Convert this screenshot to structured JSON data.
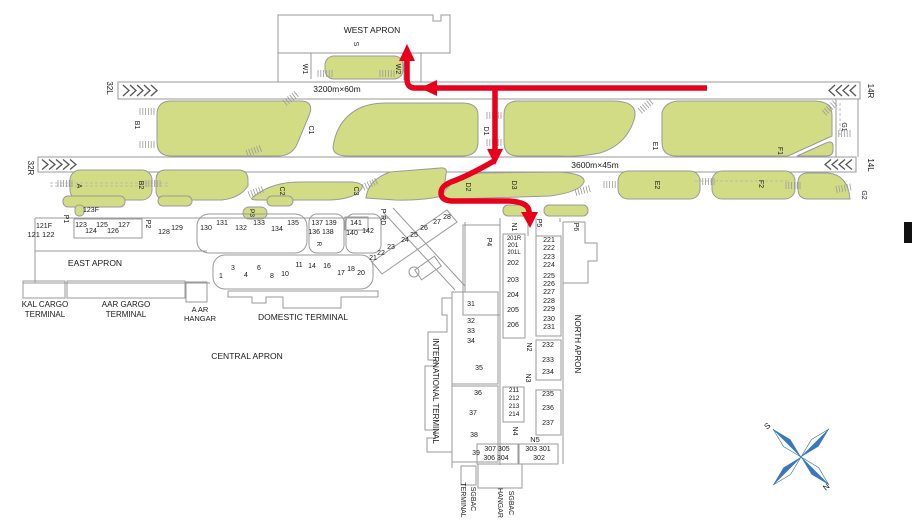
{
  "colors": {
    "island_green": "#d2dc85",
    "outline_gray": "#9a9a9a",
    "route_red": "#e8001c",
    "compass_blue": "#3a77bb",
    "text": "#1a1a1a"
  },
  "route": {
    "color": "#e8001c",
    "style": "arrow-path"
  },
  "labels": [
    {
      "n": "apron-west-label",
      "t": "WEST APRON",
      "x": 372,
      "y": 33,
      "r": 0,
      "fs": 8.5
    },
    {
      "n": "taxiway-label-s",
      "t": "S",
      "x": 354,
      "y": 44,
      "r": 90,
      "fs": 7
    },
    {
      "n": "taxiway-label-w1",
      "t": "W1",
      "x": 303,
      "y": 69,
      "r": 90,
      "fs": 7
    },
    {
      "n": "taxiway-label-w2",
      "t": "W2",
      "x": 396,
      "y": 69,
      "r": 90,
      "fs": 7
    },
    {
      "n": "runway-dimensions-1",
      "t": "3200m×60m",
      "x": 337,
      "y": 92,
      "r": 0,
      "fs": 8.5
    },
    {
      "n": "runway-dimensions-2",
      "t": "3600m×45m",
      "x": 595,
      "y": 168,
      "r": 0,
      "fs": 8.5
    },
    {
      "n": "runway-designator-32l",
      "t": "32L",
      "x": 107,
      "y": 88,
      "r": 90,
      "fs": 8
    },
    {
      "n": "runway-designator-32r",
      "t": "32R",
      "x": 28,
      "y": 168,
      "r": 90,
      "fs": 8
    },
    {
      "n": "runway-designator-14r",
      "t": "14R",
      "x": 868,
      "y": 91,
      "r": 90,
      "fs": 8
    },
    {
      "n": "runway-designator-14l",
      "t": "14L",
      "x": 868,
      "y": 165,
      "r": 90,
      "fs": 8
    },
    {
      "n": "taxiway-label-a",
      "t": "A",
      "x": 77,
      "y": 186,
      "r": 90,
      "fs": 7
    },
    {
      "n": "taxiway-label-b1",
      "t": "B1",
      "x": 135,
      "y": 125,
      "r": 90,
      "fs": 7
    },
    {
      "n": "taxiway-label-b2",
      "t": "B2",
      "x": 139,
      "y": 185,
      "r": 90,
      "fs": 7
    },
    {
      "n": "taxiway-label-c1",
      "t": "C1",
      "x": 309,
      "y": 130,
      "r": 90,
      "fs": 7
    },
    {
      "n": "taxiway-label-c2",
      "t": "C2",
      "x": 280,
      "y": 191,
      "r": 90,
      "fs": 7
    },
    {
      "n": "taxiway-label-c3",
      "t": "C3",
      "x": 354,
      "y": 191,
      "r": 90,
      "fs": 7
    },
    {
      "n": "taxiway-label-d1",
      "t": "D1",
      "x": 484,
      "y": 131,
      "r": 90,
      "fs": 7
    },
    {
      "n": "taxiway-label-d2",
      "t": "D2",
      "x": 466,
      "y": 187,
      "r": 90,
      "fs": 7
    },
    {
      "n": "taxiway-label-d3",
      "t": "D3",
      "x": 512,
      "y": 185,
      "r": 90,
      "fs": 7
    },
    {
      "n": "taxiway-label-e1",
      "t": "E1",
      "x": 653,
      "y": 146,
      "r": 90,
      "fs": 7
    },
    {
      "n": "taxiway-label-e2",
      "t": "E2",
      "x": 655,
      "y": 185,
      "r": 90,
      "fs": 7
    },
    {
      "n": "taxiway-label-f1",
      "t": "F1",
      "x": 778,
      "y": 151,
      "r": 90,
      "fs": 7
    },
    {
      "n": "taxiway-label-f2",
      "t": "F2",
      "x": 759,
      "y": 184,
      "r": 90,
      "fs": 7
    },
    {
      "n": "taxiway-label-g1",
      "t": "G1",
      "x": 842,
      "y": 127,
      "r": 90,
      "fs": 7
    },
    {
      "n": "taxiway-label-g2",
      "t": "G2",
      "x": 862,
      "y": 195,
      "r": 90,
      "fs": 7
    },
    {
      "n": "stand-121f",
      "t": "121F",
      "x": 44,
      "y": 228,
      "r": 0,
      "fs": 7
    },
    {
      "n": "stand-121-122",
      "t": "121 122",
      "x": 41,
      "y": 237,
      "r": 0,
      "fs": 7.5
    },
    {
      "n": "taxiway-label-p1",
      "t": "P1",
      "x": 64,
      "y": 219,
      "r": 90,
      "fs": 7
    },
    {
      "n": "stand-123f",
      "t": "123F",
      "x": 91,
      "y": 212,
      "r": 0,
      "fs": 7
    },
    {
      "n": "stand-123",
      "t": "123",
      "x": 81,
      "y": 227,
      "r": 0,
      "fs": 7
    },
    {
      "n": "stand-124",
      "t": "124",
      "x": 91,
      "y": 233,
      "r": 0,
      "fs": 7
    },
    {
      "n": "stand-125",
      "t": "125",
      "x": 102,
      "y": 227,
      "r": 0,
      "fs": 7
    },
    {
      "n": "stand-126",
      "t": "126",
      "x": 113,
      "y": 233,
      "r": 0,
      "fs": 7
    },
    {
      "n": "stand-127",
      "t": "127",
      "x": 124,
      "y": 227,
      "r": 0,
      "fs": 7
    },
    {
      "n": "taxiway-label-p2",
      "t": "P2",
      "x": 146,
      "y": 224,
      "r": 90,
      "fs": 7
    },
    {
      "n": "stand-128",
      "t": "128",
      "x": 164,
      "y": 234,
      "r": 0,
      "fs": 7
    },
    {
      "n": "stand-129",
      "t": "129",
      "x": 177,
      "y": 230,
      "r": 0,
      "fs": 7
    },
    {
      "n": "stand-130",
      "t": "130",
      "x": 206,
      "y": 230,
      "r": 0,
      "fs": 7
    },
    {
      "n": "stand-131",
      "t": "131",
      "x": 222,
      "y": 225,
      "r": 0,
      "fs": 7
    },
    {
      "n": "stand-132",
      "t": "132",
      "x": 241,
      "y": 230,
      "r": 0,
      "fs": 7
    },
    {
      "n": "stand-133",
      "t": "133",
      "x": 259,
      "y": 225,
      "r": 0,
      "fs": 7
    },
    {
      "n": "stand-134",
      "t": "134",
      "x": 277,
      "y": 231,
      "r": 0,
      "fs": 7
    },
    {
      "n": "stand-135",
      "t": "135",
      "x": 293,
      "y": 225,
      "r": 0,
      "fs": 7
    },
    {
      "n": "stand-137-139",
      "t": "137 139",
      "x": 324,
      "y": 225,
      "r": 0,
      "fs": 7
    },
    {
      "n": "stand-136-138",
      "t": "136 138",
      "x": 321,
      "y": 234,
      "r": 0,
      "fs": 7
    },
    {
      "n": "taxiway-label-r",
      "t": "R",
      "x": 317,
      "y": 244,
      "r": 90,
      "fs": 6.5
    },
    {
      "n": "stand-141",
      "t": "141",
      "x": 356,
      "y": 225,
      "r": 0,
      "fs": 7
    },
    {
      "n": "stand-140",
      "t": "140",
      "x": 352,
      "y": 235,
      "r": 0,
      "fs": 7
    },
    {
      "n": "stand-142",
      "t": "142",
      "x": 368,
      "y": 233,
      "r": 0,
      "fs": 7
    },
    {
      "n": "taxiway-label-p3",
      "t": "P3",
      "x": 250,
      "y": 213,
      "r": 90,
      "fs": 6.5
    },
    {
      "n": "road-label-p-rd",
      "t": "P RD",
      "x": 381,
      "y": 217,
      "r": 90,
      "fs": 7
    },
    {
      "n": "apron-east-label",
      "t": "EAST APRON",
      "x": 95,
      "y": 266,
      "r": 0,
      "fs": 8.5
    },
    {
      "n": "stand-1",
      "t": "1",
      "x": 221,
      "y": 278,
      "r": 0,
      "fs": 7
    },
    {
      "n": "stand-3",
      "t": "3",
      "x": 233,
      "y": 270,
      "r": 0,
      "fs": 7
    },
    {
      "n": "stand-4",
      "t": "4",
      "x": 246,
      "y": 277,
      "r": 0,
      "fs": 7
    },
    {
      "n": "stand-6",
      "t": "6",
      "x": 259,
      "y": 270,
      "r": 0,
      "fs": 7
    },
    {
      "n": "stand-8",
      "t": "8",
      "x": 272,
      "y": 278,
      "r": 0,
      "fs": 7
    },
    {
      "n": "stand-10",
      "t": "10",
      "x": 285,
      "y": 276,
      "r": 0,
      "fs": 7
    },
    {
      "n": "stand-11",
      "t": "11",
      "x": 299,
      "y": 267,
      "r": 0,
      "fs": 7
    },
    {
      "n": "stand-14",
      "t": "14",
      "x": 312,
      "y": 268,
      "r": 0,
      "fs": 7
    },
    {
      "n": "stand-16",
      "t": "16",
      "x": 327,
      "y": 268,
      "r": 0,
      "fs": 7
    },
    {
      "n": "stand-17",
      "t": "17",
      "x": 341,
      "y": 275,
      "r": 0,
      "fs": 7
    },
    {
      "n": "stand-18",
      "t": "18",
      "x": 351,
      "y": 271,
      "r": 0,
      "fs": 7
    },
    {
      "n": "stand-20",
      "t": "20",
      "x": 361,
      "y": 275,
      "r": 0,
      "fs": 7
    },
    {
      "n": "stand-21",
      "t": "21",
      "x": 373,
      "y": 260,
      "r": 0,
      "fs": 7
    },
    {
      "n": "stand-22",
      "t": "22",
      "x": 381,
      "y": 255,
      "r": 0,
      "fs": 7
    },
    {
      "n": "stand-23",
      "t": "23",
      "x": 391,
      "y": 249,
      "r": 0,
      "fs": 7
    },
    {
      "n": "stand-24",
      "t": "24",
      "x": 405,
      "y": 242,
      "r": 0,
      "fs": 7
    },
    {
      "n": "stand-25",
      "t": "25",
      "x": 414,
      "y": 237,
      "r": 0,
      "fs": 7
    },
    {
      "n": "stand-26",
      "t": "26",
      "x": 424,
      "y": 230,
      "r": 0,
      "fs": 7
    },
    {
      "n": "stand-27",
      "t": "27",
      "x": 437,
      "y": 224,
      "r": 0,
      "fs": 7
    },
    {
      "n": "stand-28",
      "t": "28",
      "x": 447,
      "y": 219,
      "r": 0,
      "fs": 7
    },
    {
      "n": "terminal-kal-cargo-line1",
      "t": "KAL CARGO",
      "x": 45,
      "y": 307,
      "r": 0,
      "fs": 8
    },
    {
      "n": "terminal-kal-cargo-line2",
      "t": "TERMINAL",
      "x": 45,
      "y": 317,
      "r": 0,
      "fs": 8
    },
    {
      "n": "terminal-aar-cargo-line1",
      "t": "AAR GARGO",
      "x": 126,
      "y": 307,
      "r": 0,
      "fs": 8
    },
    {
      "n": "terminal-aar-cargo-line2",
      "t": "TERMINAL",
      "x": 126,
      "y": 317,
      "r": 0,
      "fs": 8
    },
    {
      "n": "terminal-aar-hangar-line1",
      "t": "A AR",
      "x": 200,
      "y": 312,
      "r": 0,
      "fs": 7.5
    },
    {
      "n": "terminal-aar-hangar-line2",
      "t": "HANGAR",
      "x": 200,
      "y": 321,
      "r": 0,
      "fs": 7.5
    },
    {
      "n": "terminal-domestic-label",
      "t": "DOMESTIC TERMINAL",
      "x": 303,
      "y": 320,
      "r": 0,
      "fs": 8.5
    },
    {
      "n": "apron-central-label",
      "t": "CENTRAL APRON",
      "x": 247,
      "y": 359,
      "r": 0,
      "fs": 8.5
    },
    {
      "n": "terminal-international-label",
      "t": "INTERNATIONAL TERMINAL",
      "x": 433,
      "y": 391,
      "r": 90,
      "fs": 8
    },
    {
      "n": "apron-north-label",
      "t": "NORTH APRON",
      "x": 575,
      "y": 344,
      "r": 90,
      "fs": 8
    },
    {
      "n": "taxiway-label-p4",
      "t": "P4",
      "x": 487,
      "y": 242,
      "r": 90,
      "fs": 7
    },
    {
      "n": "taxiway-label-n1",
      "t": "N1",
      "x": 512,
      "y": 227,
      "r": 90,
      "fs": 7
    },
    {
      "n": "taxiway-label-p5",
      "t": "P5",
      "x": 537,
      "y": 223,
      "r": 90,
      "fs": 7
    },
    {
      "n": "taxiway-label-p6",
      "t": "P6",
      "x": 574,
      "y": 227,
      "r": 90,
      "fs": 7
    },
    {
      "n": "stand-201r",
      "t": "201R",
      "x": 514,
      "y": 240,
      "r": 0,
      "fs": 6
    },
    {
      "n": "stand-201",
      "t": "201",
      "x": 513,
      "y": 247,
      "r": 0,
      "fs": 6.5
    },
    {
      "n": "stand-201l",
      "t": "201L",
      "x": 514,
      "y": 254,
      "r": 0,
      "fs": 6
    },
    {
      "n": "stand-202",
      "t": "202",
      "x": 513,
      "y": 265,
      "r": 0,
      "fs": 7
    },
    {
      "n": "stand-203",
      "t": "203",
      "x": 513,
      "y": 282,
      "r": 0,
      "fs": 7
    },
    {
      "n": "stand-204",
      "t": "204",
      "x": 513,
      "y": 297,
      "r": 0,
      "fs": 7
    },
    {
      "n": "stand-205",
      "t": "205",
      "x": 513,
      "y": 312,
      "r": 0,
      "fs": 7
    },
    {
      "n": "stand-206",
      "t": "206",
      "x": 513,
      "y": 327,
      "r": 0,
      "fs": 7
    },
    {
      "n": "stand-221",
      "t": "221",
      "x": 549,
      "y": 242,
      "r": 0,
      "fs": 7
    },
    {
      "n": "stand-222",
      "t": "222",
      "x": 549,
      "y": 250,
      "r": 0,
      "fs": 7
    },
    {
      "n": "stand-223",
      "t": "223",
      "x": 549,
      "y": 259,
      "r": 0,
      "fs": 7
    },
    {
      "n": "stand-224",
      "t": "224",
      "x": 549,
      "y": 267,
      "r": 0,
      "fs": 7
    },
    {
      "n": "stand-225",
      "t": "225",
      "x": 549,
      "y": 278,
      "r": 0,
      "fs": 7
    },
    {
      "n": "stand-226",
      "t": "226",
      "x": 549,
      "y": 286,
      "r": 0,
      "fs": 7
    },
    {
      "n": "stand-227",
      "t": "227",
      "x": 549,
      "y": 294,
      "r": 0,
      "fs": 7
    },
    {
      "n": "stand-228",
      "t": "228",
      "x": 549,
      "y": 303,
      "r": 0,
      "fs": 7
    },
    {
      "n": "stand-229",
      "t": "229",
      "x": 549,
      "y": 311,
      "r": 0,
      "fs": 7
    },
    {
      "n": "stand-230",
      "t": "230",
      "x": 549,
      "y": 321,
      "r": 0,
      "fs": 7
    },
    {
      "n": "stand-231",
      "t": "231",
      "x": 549,
      "y": 329,
      "r": 0,
      "fs": 7
    },
    {
      "n": "taxiway-label-n2",
      "t": "N2",
      "x": 527,
      "y": 347,
      "r": 90,
      "fs": 7
    },
    {
      "n": "stand-232",
      "t": "232",
      "x": 548,
      "y": 347,
      "r": 0,
      "fs": 7
    },
    {
      "n": "stand-233",
      "t": "233",
      "x": 548,
      "y": 362,
      "r": 0,
      "fs": 7
    },
    {
      "n": "stand-234",
      "t": "234",
      "x": 548,
      "y": 374,
      "r": 0,
      "fs": 7
    },
    {
      "n": "taxiway-label-n3",
      "t": "N3",
      "x": 526,
      "y": 378,
      "r": 90,
      "fs": 7
    },
    {
      "n": "stand-211",
      "t": "211",
      "x": 514,
      "y": 392,
      "r": 0,
      "fs": 6.5
    },
    {
      "n": "stand-212",
      "t": "212",
      "x": 514,
      "y": 400,
      "r": 0,
      "fs": 6.5
    },
    {
      "n": "stand-213",
      "t": "213",
      "x": 514,
      "y": 408,
      "r": 0,
      "fs": 6.5
    },
    {
      "n": "stand-214",
      "t": "214",
      "x": 514,
      "y": 416,
      "r": 0,
      "fs": 6.5
    },
    {
      "n": "stand-235",
      "t": "235",
      "x": 548,
      "y": 396,
      "r": 0,
      "fs": 7
    },
    {
      "n": "stand-236",
      "t": "236",
      "x": 548,
      "y": 410,
      "r": 0,
      "fs": 7
    },
    {
      "n": "stand-237",
      "t": "237",
      "x": 548,
      "y": 425,
      "r": 0,
      "fs": 7
    },
    {
      "n": "taxiway-label-n4",
      "t": "N4",
      "x": 513,
      "y": 431,
      "r": 90,
      "fs": 7
    },
    {
      "n": "taxiway-label-n5",
      "t": "N5",
      "x": 535,
      "y": 442,
      "r": 0,
      "fs": 7.5
    },
    {
      "n": "stand-303-301",
      "t": "303 301",
      "x": 538,
      "y": 451,
      "r": 0,
      "fs": 7
    },
    {
      "n": "stand-302",
      "t": "302",
      "x": 539,
      "y": 460,
      "r": 0,
      "fs": 7
    },
    {
      "n": "stand-307-305",
      "t": "307 305",
      "x": 497,
      "y": 451,
      "r": 0,
      "fs": 7
    },
    {
      "n": "stand-306-304",
      "t": "306 304",
      "x": 496,
      "y": 460,
      "r": 0,
      "fs": 7
    },
    {
      "n": "stand-31",
      "t": "31",
      "x": 471,
      "y": 306,
      "r": 0,
      "fs": 7
    },
    {
      "n": "stand-32",
      "t": "32",
      "x": 471,
      "y": 323,
      "r": 0,
      "fs": 7
    },
    {
      "n": "stand-33",
      "t": "33",
      "x": 471,
      "y": 333,
      "r": 0,
      "fs": 7
    },
    {
      "n": "stand-34",
      "t": "34",
      "x": 471,
      "y": 343,
      "r": 0,
      "fs": 7
    },
    {
      "n": "stand-35",
      "t": "35",
      "x": 479,
      "y": 370,
      "r": 0,
      "fs": 7
    },
    {
      "n": "stand-36",
      "t": "36",
      "x": 478,
      "y": 395,
      "r": 0,
      "fs": 7
    },
    {
      "n": "stand-37",
      "t": "37",
      "x": 473,
      "y": 415,
      "r": 0,
      "fs": 7
    },
    {
      "n": "stand-38",
      "t": "38",
      "x": 474,
      "y": 437,
      "r": 0,
      "fs": 7
    },
    {
      "n": "stand-39",
      "t": "39",
      "x": 476,
      "y": 455,
      "r": 0,
      "fs": 7
    },
    {
      "n": "terminal-sgbac-terminal-line1",
      "t": "SGBAC",
      "x": 471,
      "y": 499,
      "r": 90,
      "fs": 7
    },
    {
      "n": "terminal-sgbac-terminal-line2",
      "t": "TERMINAL",
      "x": 461,
      "y": 500,
      "r": 90,
      "fs": 7
    },
    {
      "n": "terminal-sgbac-hangar-line1",
      "t": "SGBAC",
      "x": 509,
      "y": 503,
      "r": 90,
      "fs": 7
    },
    {
      "n": "terminal-sgbac-hangar-line2",
      "t": "HANGAR",
      "x": 498,
      "y": 503,
      "r": 90,
      "fs": 7
    },
    {
      "n": "compass-south-label",
      "t": "S",
      "x": 769,
      "y": 428,
      "r": -40,
      "fs": 8
    },
    {
      "n": "compass-north-label",
      "t": "N",
      "x": 828,
      "y": 489,
      "r": -40,
      "fs": 8
    }
  ]
}
